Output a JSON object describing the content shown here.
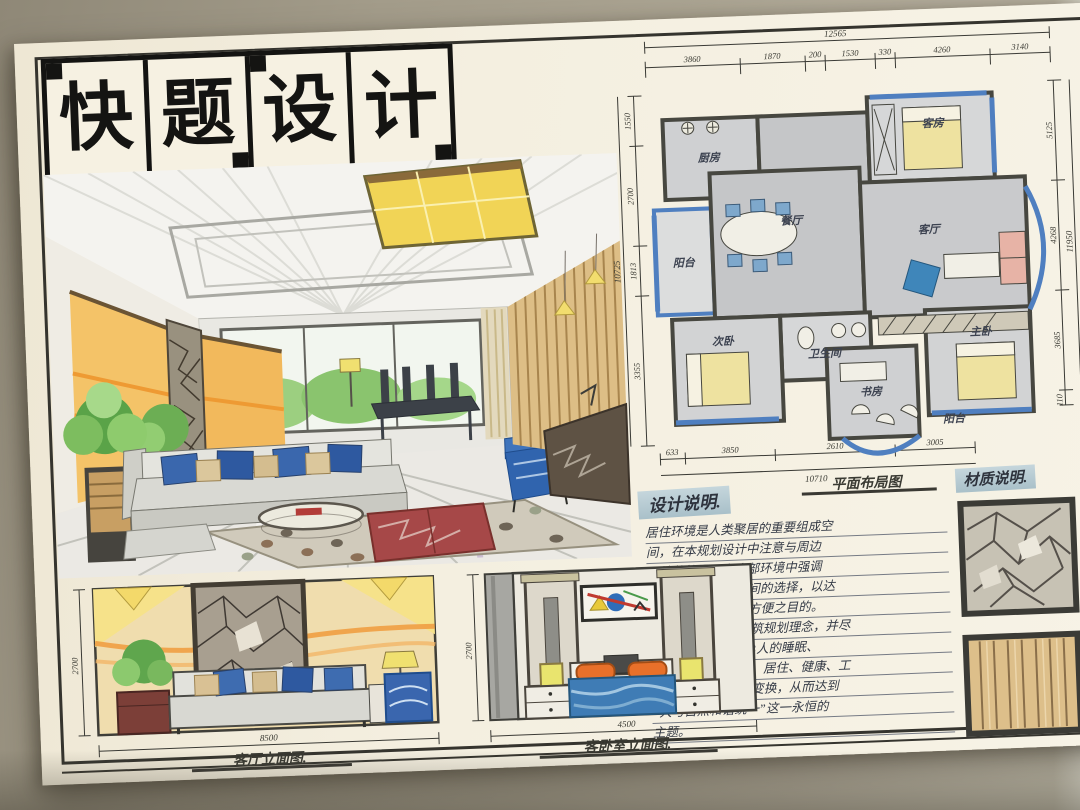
{
  "title": {
    "text": "快题设计",
    "chars": [
      "快",
      "题",
      "设",
      "计"
    ]
  },
  "floor_plan": {
    "caption": "平面布局图",
    "rooms": [
      "厨房",
      "客房",
      "餐厅",
      "客厅",
      "阳台",
      "卫生间",
      "次卧",
      "主卧",
      "书房",
      "阳台"
    ],
    "dims_top": {
      "total": "12565",
      "segments": [
        "3860",
        "1870",
        "200",
        "1530",
        "330",
        "4260",
        "3140"
      ]
    },
    "dims_bottom": {
      "total": "10710",
      "segments": [
        "633",
        "3850",
        "2610",
        "3005"
      ]
    },
    "dims_left": {
      "total": "10725",
      "segments": [
        "1550",
        "2700",
        "1813",
        "3355"
      ]
    },
    "dims_right": {
      "total": "11950",
      "segments": [
        "5125",
        "4268",
        "3685",
        "110"
      ]
    }
  },
  "design_notes": {
    "heading": "设计说明.",
    "lines": [
      "居住环境是人类聚居的重要组成空",
      "间，在本规划设计中注意与周边",
      "环境的协调，在内部环境中强调",
      "生活、文化、美观间的选择，以达",
      "到美化环境、生活方便之目的。",
      "秉“以人为本”的建筑规划理念，并尽",
      "可能的解决和改善3人的睡眠、",
      "娱乐、休闲、聚会、居住、健康、工",
      "作、交流等之间的变换，从而达到",
      "“人与自然和谐统一”这一永恒的",
      "主题。"
    ]
  },
  "material_notes": {
    "heading": "材质说明."
  },
  "elevations": {
    "living": {
      "caption": "客厅立面图.",
      "width_dim": "8500",
      "height_dim": "2700"
    },
    "bedroom": {
      "caption": "客卧室立面图.",
      "width_dim": "4500",
      "height_dim": "2700"
    }
  },
  "colors": {
    "paper": "#f4efe0",
    "table": "#a39c8a",
    "ink": "#33322c",
    "header_highlight": "#b9cdd4",
    "marker_blue": "#3a67ad",
    "marker_orange": "#ef9a3f",
    "marker_yellow": "#f1d456",
    "marker_red": "#a64848",
    "marker_green": "#6cae54",
    "wood": "#ddbe86",
    "stone": "#a19889",
    "plan_gray": "#c5c6c8"
  }
}
